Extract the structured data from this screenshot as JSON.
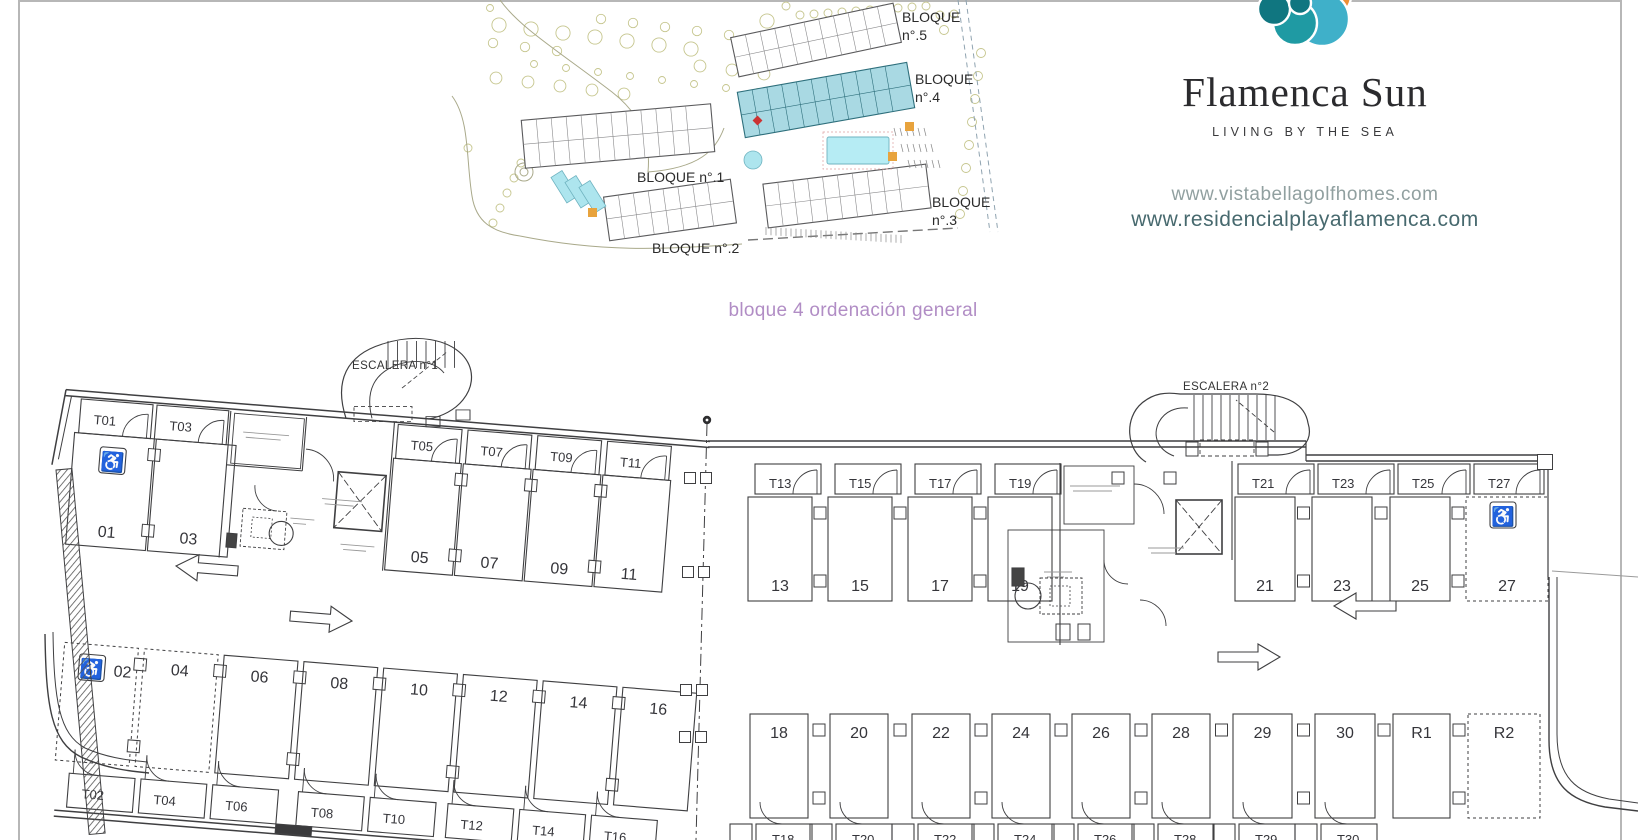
{
  "caption": "bloque 4 ordenación general",
  "brand": {
    "name": "Flamenca Sun",
    "tagline": "LIVING BY THE SEA",
    "url_primary": "www.vistabellagolfhomes.com",
    "url_secondary": "www.residencialplayaflamenca.com"
  },
  "colors": {
    "caption_text": "#b18dc5",
    "url_primary": "#91a0a0",
    "url_secondary": "#47696e",
    "plan_ink": "#3f3f41",
    "site_highlight": "#a9d9e3",
    "logo": {
      "teal_dark": "#107680",
      "teal": "#1f9aa3",
      "blue": "#3fb0c9",
      "yellow": "#f2c12e",
      "orange": "#ee8f35"
    }
  },
  "site_plan": {
    "block5": [
      "BLOQUE",
      "n°.5"
    ],
    "block4": [
      "BLOQUE",
      "n°.4"
    ],
    "block1": "BLOQUE n°.1",
    "block2": "BLOQUE n°.2",
    "block3": [
      "BLOQUE",
      "n°.3"
    ]
  },
  "floor_plan": {
    "stair1_label": "ESCALERA n°1",
    "stair2_label": "ESCALERA n°2",
    "left_wing": {
      "top_trasteros": [
        "T01",
        "T03",
        "T05",
        "T07",
        "T09",
        "T11"
      ],
      "top_parking": [
        "01",
        "03",
        "05",
        "07",
        "09",
        "11"
      ],
      "bottom_parking": [
        "02",
        "04",
        "06",
        "08",
        "10",
        "12",
        "14",
        "16"
      ],
      "bottom_trasteros": [
        "T02",
        "T04",
        "T06",
        "T08",
        "T10",
        "T12",
        "T14",
        "T16"
      ]
    },
    "right_wing": {
      "top_trasteros": [
        "T13",
        "T15",
        "T17",
        "T19",
        "T21",
        "T23",
        "T25",
        "T27"
      ],
      "top_parking": [
        "13",
        "15",
        "17",
        "19",
        "21",
        "23",
        "25",
        "27"
      ],
      "bottom_parking": [
        "18",
        "20",
        "22",
        "24",
        "26",
        "28",
        "29",
        "30",
        "R1",
        "R2"
      ],
      "bottom_trasteros": [
        "T18",
        "T20",
        "T22",
        "T24",
        "T26",
        "T28",
        "T29",
        "T30"
      ]
    },
    "accessible_spaces": [
      "01",
      "02",
      "27"
    ],
    "reserved_dashed_spaces": [
      "02",
      "04",
      "27",
      "R2"
    ],
    "wheelchair_icon": "♿"
  }
}
